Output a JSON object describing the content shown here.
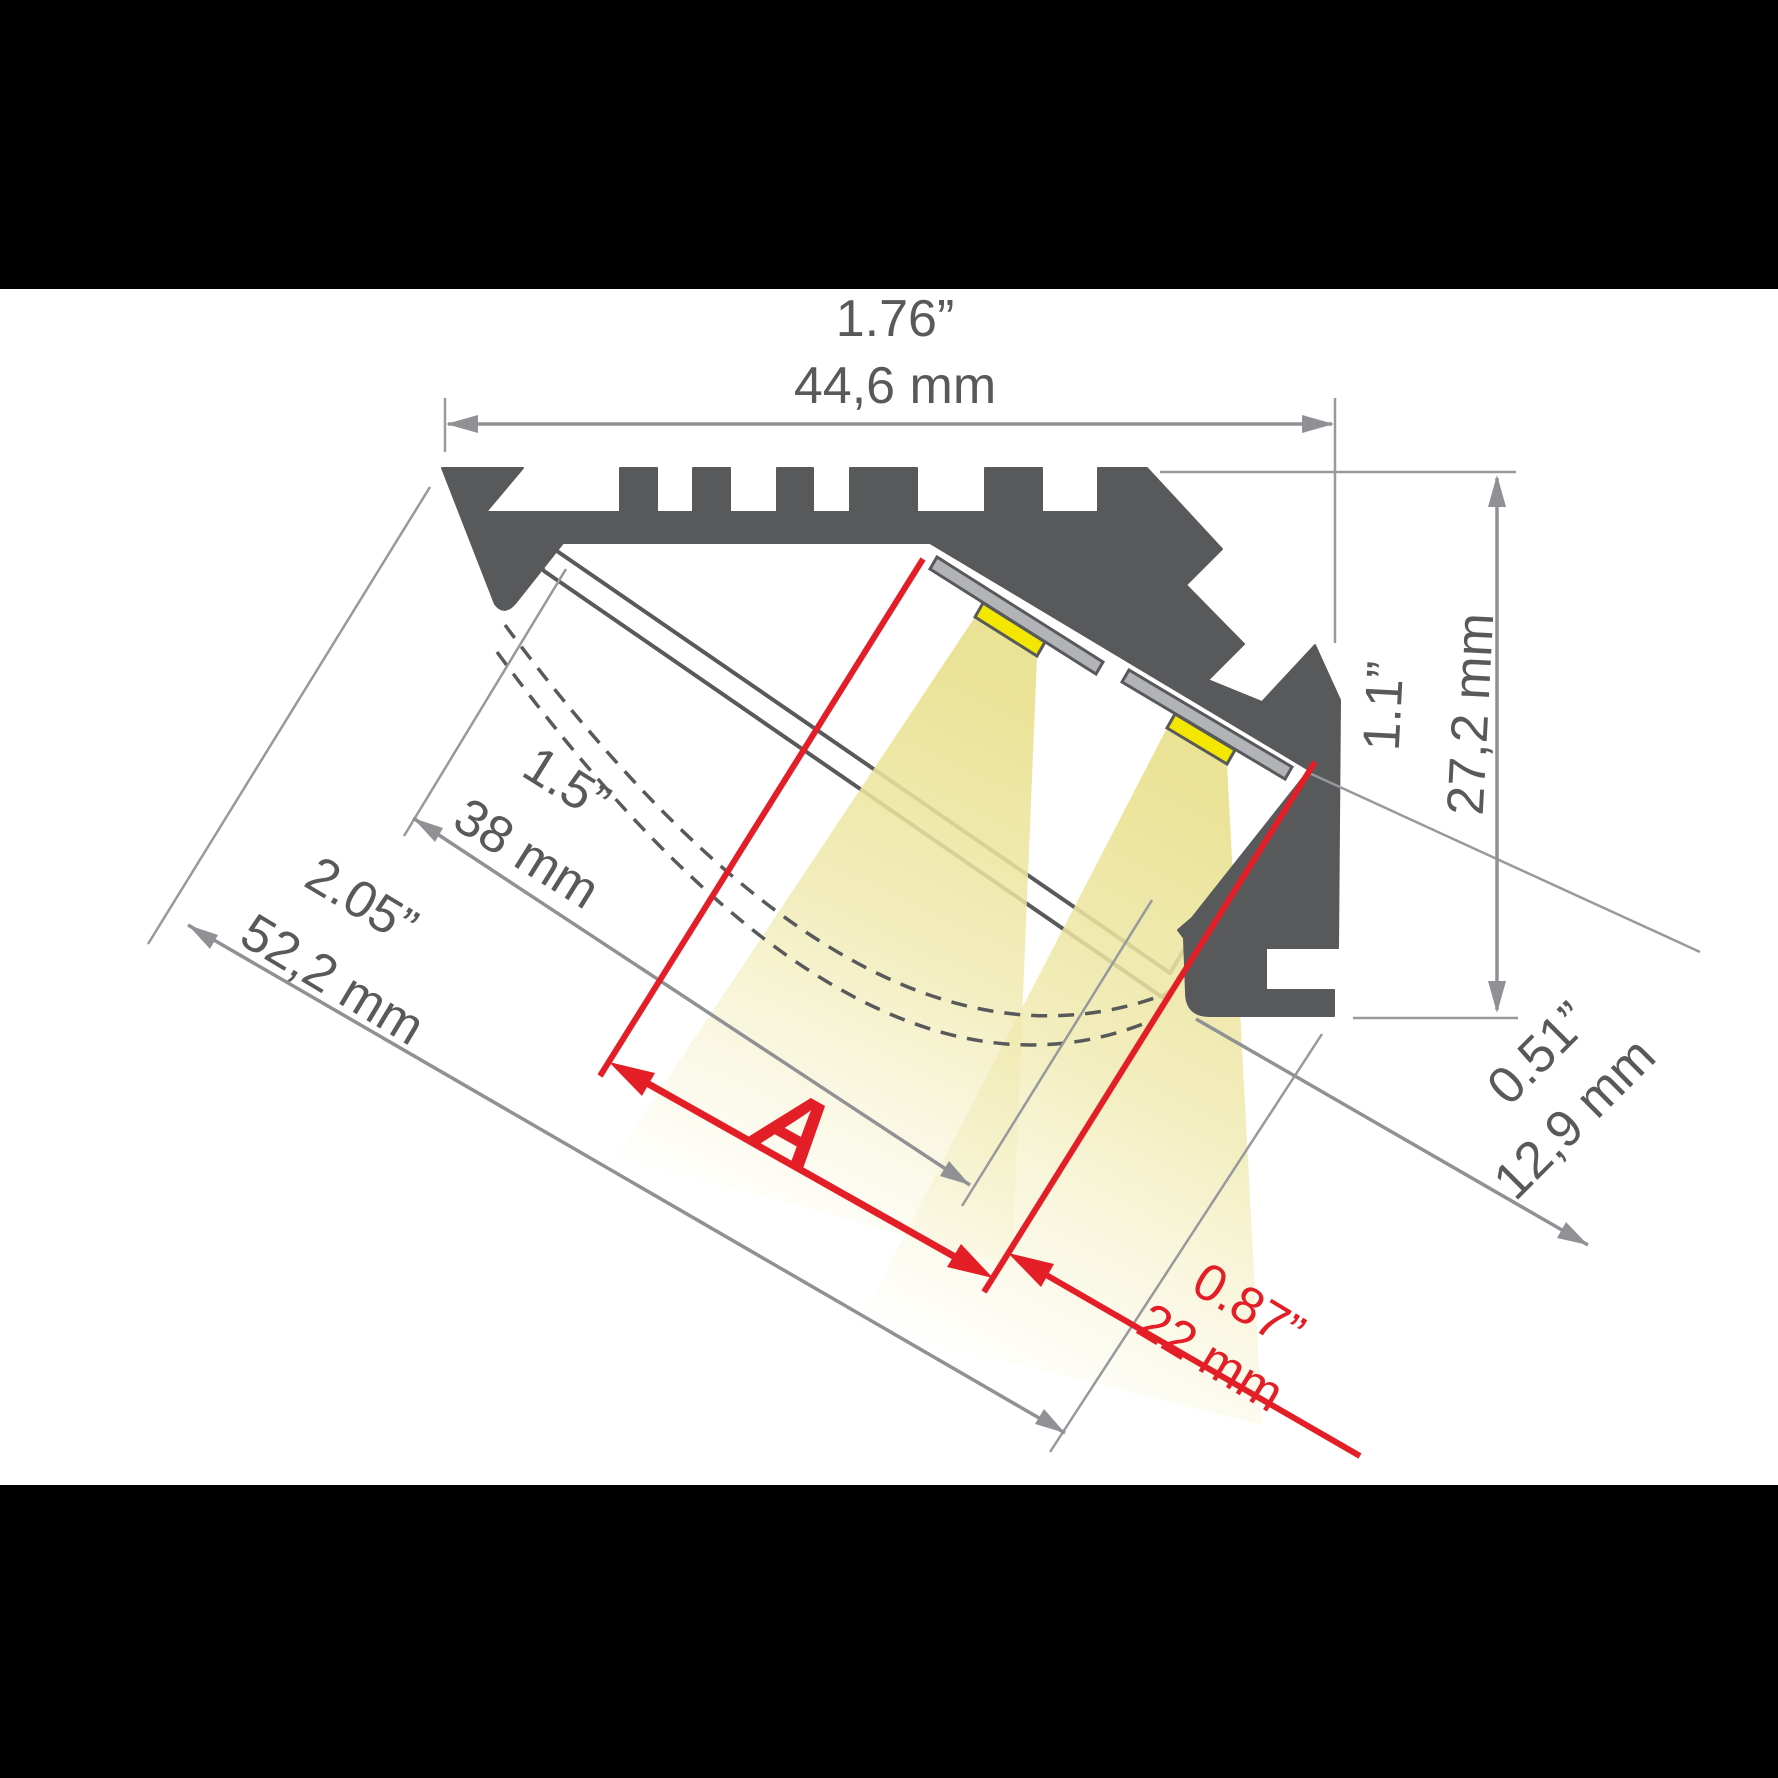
{
  "diagram": {
    "type": "led-profile-cross-section-dimension-drawing",
    "colors": {
      "background": "#ffffff",
      "letterbox": "#000000",
      "profile_body": "#58595b",
      "dimension_lines": "#8f9194",
      "dimension_text": "#58595b",
      "accent_red": "#e41e26",
      "led_yellow": "#f3e600",
      "light_beam": "#ebe39b",
      "pcb_strip_gray": "#b1b3b6"
    },
    "dims": {
      "top": {
        "in": "1.76”",
        "mm": "44,6 mm"
      },
      "right": {
        "in": "1.1”",
        "mm": "27,2 mm"
      },
      "inner": {
        "in": "1.5”",
        "mm": "38 mm"
      },
      "outer": {
        "in": "2.05”",
        "mm": "52,2 mm"
      },
      "foot": {
        "in": "0.51”",
        "mm": "12,9 mm"
      },
      "led": {
        "in": "0.87”",
        "mm": "22 mm"
      },
      "a_label": "A"
    }
  }
}
